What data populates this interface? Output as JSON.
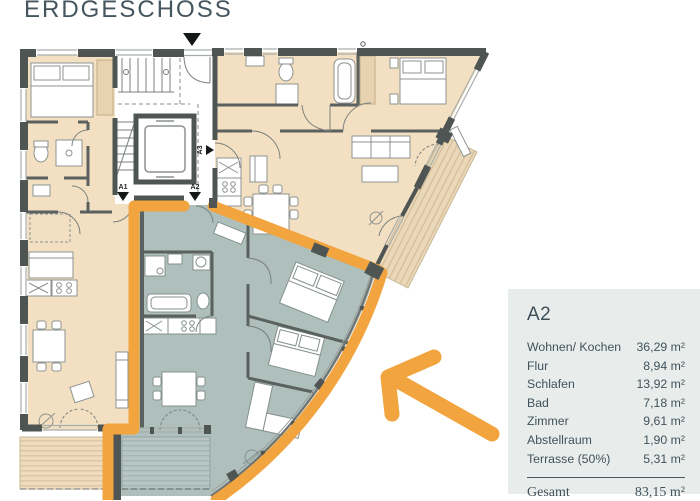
{
  "title": "ERDGESCHOSS",
  "panel": {
    "apartment": "A2",
    "rows": [
      {
        "label": "Wohnen/ Kochen",
        "value": "36,29 m²"
      },
      {
        "label": "Flur",
        "value": "8,94 m²"
      },
      {
        "label": "Schlafen",
        "value": "13,92 m²"
      },
      {
        "label": "Bad",
        "value": "7,18 m²"
      },
      {
        "label": "Zimmer",
        "value": "9,61 m²"
      },
      {
        "label": "Abstellraum",
        "value": "1,90 m²"
      },
      {
        "label": "Terrasse (50%)",
        "value": "5,31 m²"
      }
    ],
    "total_label": "Gesamt",
    "total_value": "83,15 m²"
  },
  "plan": {
    "markers": [
      {
        "label": "A1"
      },
      {
        "label": "A2"
      },
      {
        "label": "A3"
      }
    ]
  },
  "colors": {
    "accent_orange": "#F2A43F",
    "panel_bg": "#E8EDEC",
    "apartment_beige": "#F3E0C2",
    "highlight_sage": "#AEBFBC",
    "wall_dark": "#4E5553",
    "text": "#41525B"
  }
}
